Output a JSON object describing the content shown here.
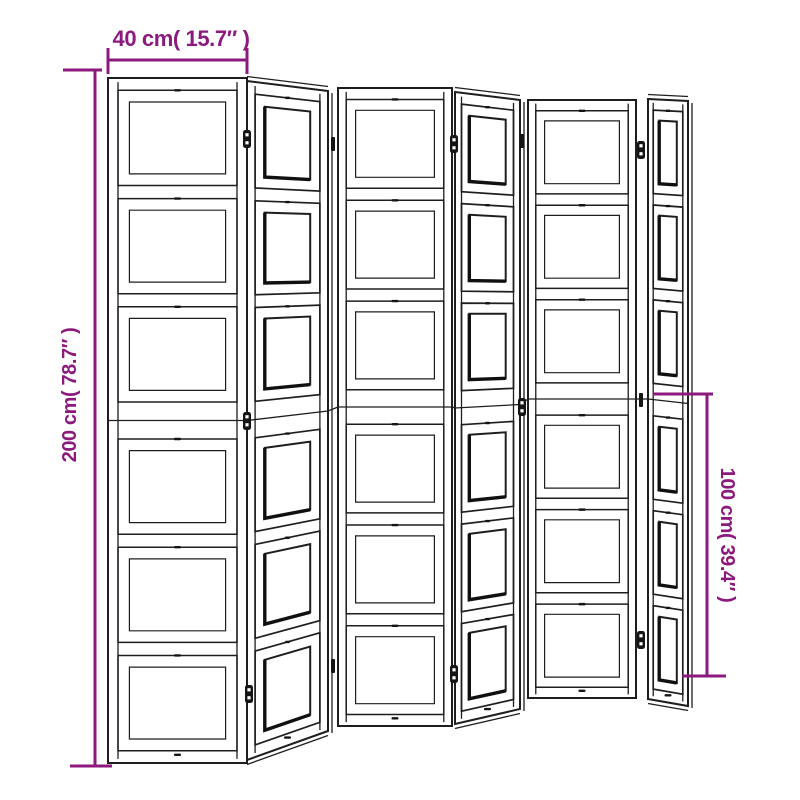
{
  "meta": {
    "title": "Room divider dimension diagram",
    "panel_style": "zigzag folding screen line drawing"
  },
  "colors": {
    "dimension": "#8c1a7e",
    "line": "#1e1e1e",
    "background": "#ffffff"
  },
  "annotations": {
    "width": {
      "label": "40 cm( 15.7″ )"
    },
    "height_total": {
      "label": "200 cm( 78.7″ )"
    },
    "height_half": {
      "label": "100 cm( 39.4″ )"
    }
  },
  "divider": {
    "panel_count": 6,
    "sections_per_panel": 6,
    "panels": [
      {
        "id": "panel-1",
        "type": "front",
        "stile": 0.072,
        "inner_inset": 0.082,
        "quad": {
          "tl": [
            108,
            78
          ],
          "tr": [
            247,
            78
          ],
          "br": [
            247,
            763
          ],
          "bl": [
            108,
            763
          ]
        }
      },
      {
        "id": "panel-2",
        "type": "angled",
        "stile": 0.1,
        "inner_inset": 0.12,
        "quad": {
          "tl": [
            247,
            81
          ],
          "tr": [
            328,
            91
          ],
          "br": [
            328,
            731
          ],
          "bl": [
            247,
            760
          ]
        }
      },
      {
        "id": "panel-3",
        "type": "front",
        "stile": 0.072,
        "inner_inset": 0.082,
        "quad": {
          "tl": [
            338,
            88
          ],
          "tr": [
            452,
            88
          ],
          "br": [
            452,
            726
          ],
          "bl": [
            338,
            726
          ]
        }
      },
      {
        "id": "panel-4",
        "type": "angled",
        "stile": 0.1,
        "inner_inset": 0.12,
        "quad": {
          "tl": [
            455,
            92
          ],
          "tr": [
            520,
            100
          ],
          "br": [
            520,
            709
          ],
          "bl": [
            455,
            724
          ]
        }
      },
      {
        "id": "panel-5",
        "type": "front",
        "stile": 0.072,
        "inner_inset": 0.082,
        "quad": {
          "tl": [
            528,
            100
          ],
          "tr": [
            636,
            100
          ],
          "br": [
            636,
            698
          ],
          "bl": [
            528,
            698
          ]
        }
      },
      {
        "id": "panel-6",
        "type": "angled",
        "stile": 0.13,
        "inner_inset": 0.15,
        "quad": {
          "tl": [
            648,
            99
          ],
          "tr": [
            688,
            101
          ],
          "br": [
            688,
            706
          ],
          "bl": [
            648,
            699
          ]
        }
      }
    ],
    "hinges": [
      {
        "x": 247,
        "y": 139,
        "style": "block"
      },
      {
        "x": 247,
        "y": 421,
        "style": "block"
      },
      {
        "x": 249,
        "y": 694,
        "style": "block"
      },
      {
        "x": 333,
        "y": 144,
        "style": "pin"
      },
      {
        "x": 333,
        "y": 666,
        "style": "pin"
      },
      {
        "x": 454,
        "y": 144,
        "style": "block"
      },
      {
        "x": 454,
        "y": 674,
        "style": "block"
      },
      {
        "x": 522,
        "y": 141,
        "style": "pin"
      },
      {
        "x": 522,
        "y": 407,
        "style": "block"
      },
      {
        "x": 641,
        "y": 150,
        "style": "block"
      },
      {
        "x": 641,
        "y": 400,
        "style": "pin"
      },
      {
        "x": 641,
        "y": 640,
        "style": "block"
      }
    ]
  }
}
